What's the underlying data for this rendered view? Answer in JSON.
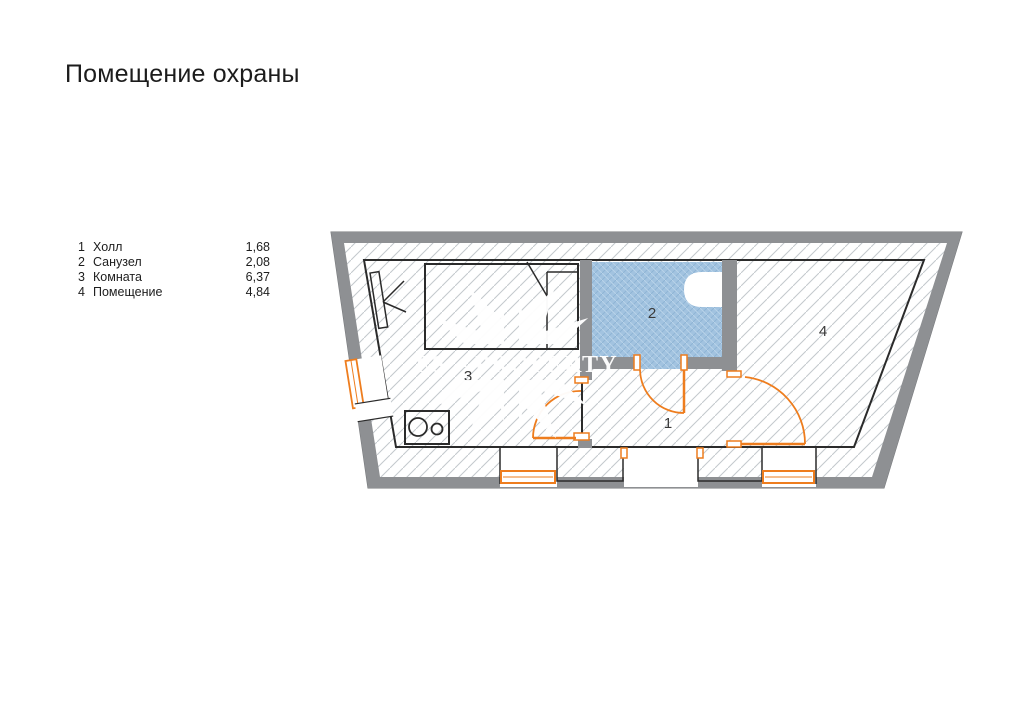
{
  "title": "Помещение охраны",
  "legend": {
    "items": [
      {
        "num": "1",
        "name": "Холл",
        "value": "1,68"
      },
      {
        "num": "2",
        "name": "Санузел",
        "value": "2,08"
      },
      {
        "num": "3",
        "name": "Комната",
        "value": "6,37"
      },
      {
        "num": "4",
        "name": "Помещение",
        "value": "4,84"
      }
    ]
  },
  "plan": {
    "rooms": [
      {
        "label": "1"
      },
      {
        "label": "2"
      },
      {
        "label": "3"
      },
      {
        "label": "4"
      }
    ]
  },
  "watermark": {
    "text": "FS – PROPERTY"
  },
  "colors": {
    "accent_orange": "#ee7d1e",
    "floor_beige": "#f4dfc8",
    "floor_stripe": "#e9ceb2",
    "bath_blue": "#a2c3e0",
    "bath_blue_dark": "#8db3d4",
    "bath_blue_light": "#bad4ea",
    "wall_gray": "#8e9093",
    "hatch_line": "#c3c8cd",
    "outline_dark": "#2b2b2b",
    "label_color": "#3a3a3a",
    "watermark_white": "#ffffff"
  }
}
